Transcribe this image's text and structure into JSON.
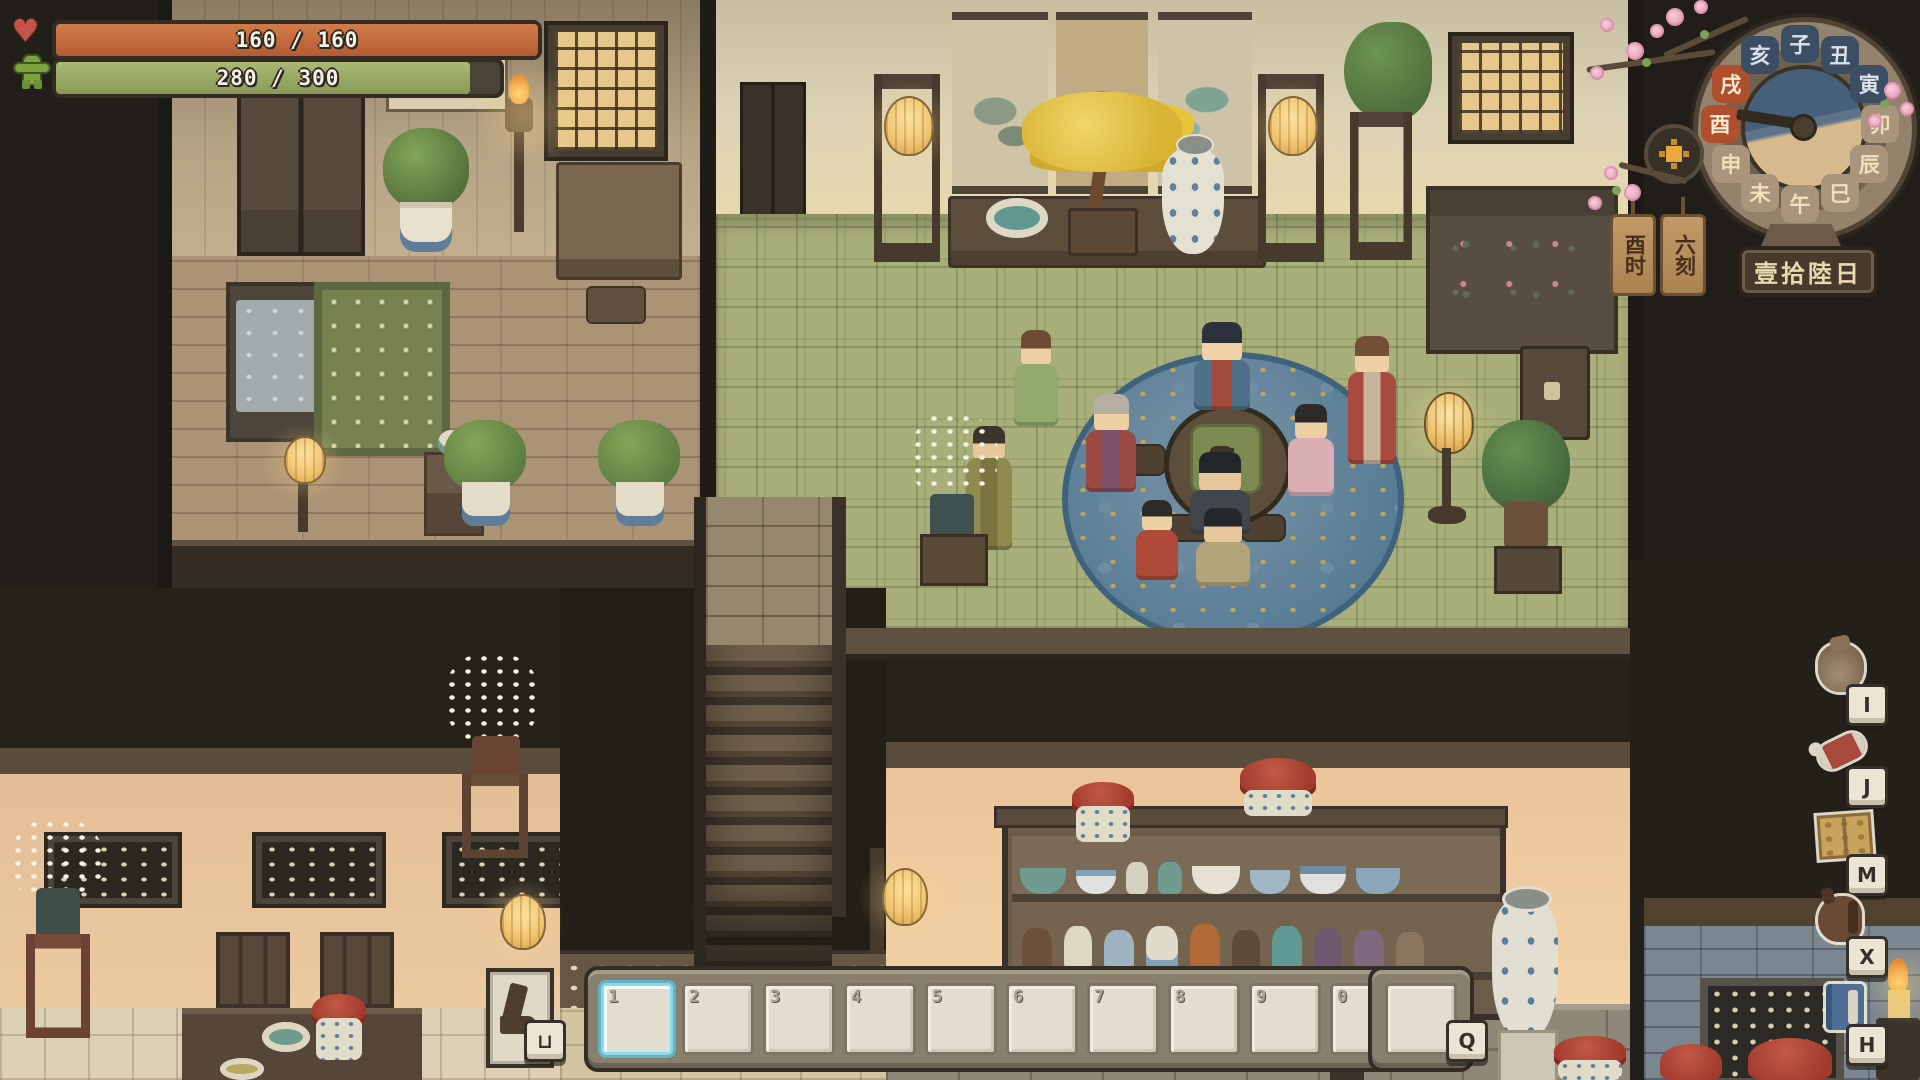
{
  "hud": {
    "health": {
      "current": 160,
      "max": 160,
      "label": "160 / 160",
      "fill_color": "#c2653a"
    },
    "stamina": {
      "current": 280,
      "max": 300,
      "label": "280 / 300",
      "fill_color": "#9cab6d"
    }
  },
  "clock": {
    "zodiac_hours": [
      "子",
      "丑",
      "寅",
      "卯",
      "辰",
      "巳",
      "午",
      "未",
      "申",
      "酉",
      "戌",
      "亥"
    ],
    "night_hours": [
      "亥",
      "子",
      "丑",
      "寅"
    ],
    "highlight_hours": [
      "酉",
      "戌"
    ],
    "hour_tag": "酉时",
    "quarter_tag": "六刻",
    "day_plaque": "壹拾陸日",
    "highlight_color": "#b04f2e",
    "night_color": "#3c4e63",
    "day_color": "#a8957c"
  },
  "shortcuts": [
    {
      "name": "inventory",
      "icon": "pouch",
      "key": "I"
    },
    {
      "name": "food",
      "icon": "meat",
      "key": "J"
    },
    {
      "name": "map",
      "icon": "map",
      "key": "M"
    },
    {
      "name": "mount",
      "icon": "horse",
      "key": "X"
    },
    {
      "name": "handbook",
      "icon": "bluebook",
      "key": "H"
    }
  ],
  "hotbar": {
    "slots": [
      "1",
      "2",
      "3",
      "4",
      "5",
      "6",
      "7",
      "8",
      "9",
      "0"
    ],
    "selected_index": 0,
    "selected_color": "#8ed7e3",
    "extra_slot_key": "Q",
    "boots_key": "⊔"
  }
}
